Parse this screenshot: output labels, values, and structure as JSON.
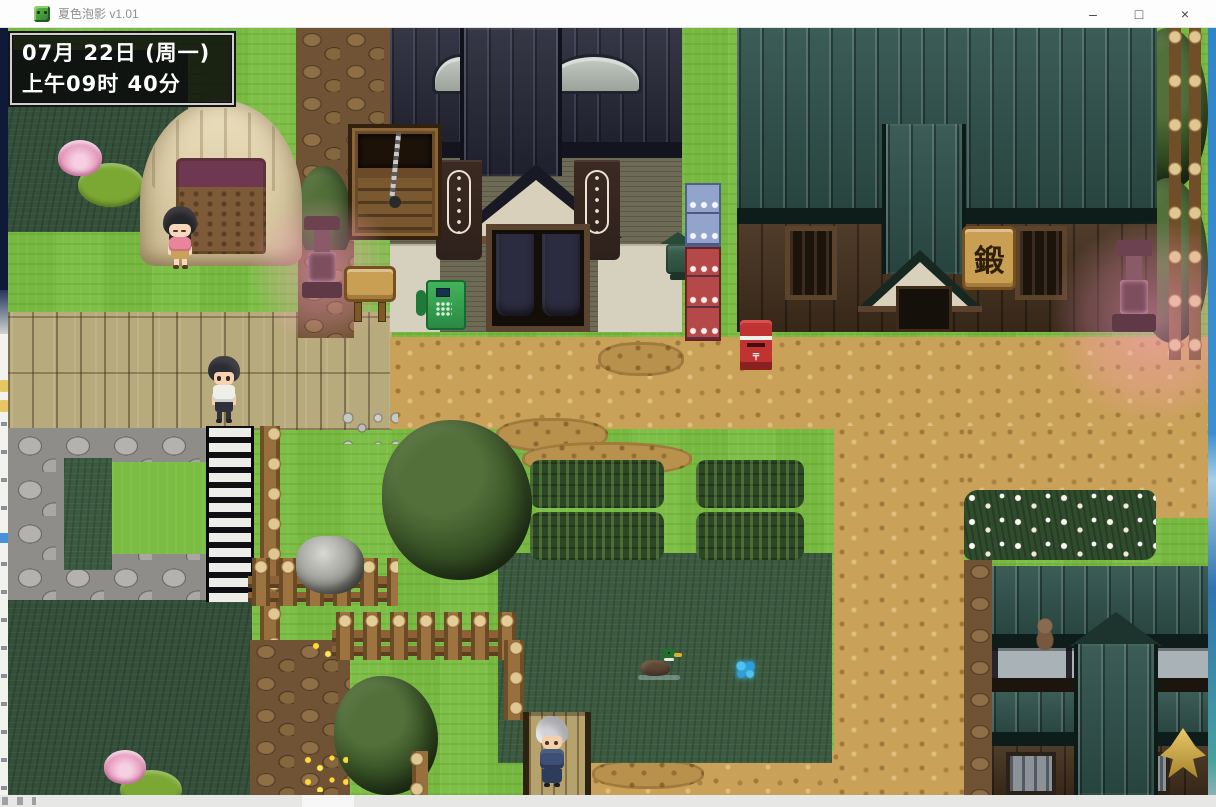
{
  "window": {
    "title": "夏色泡影 v1.01",
    "controls": {
      "minimize": "–",
      "maximize": "□",
      "close": "×"
    }
  },
  "hud": {
    "date": "07月 22日 (周一)",
    "time": "上午09时 40分"
  },
  "scene": {
    "blacksmith_sign": "鍛",
    "postbox_label": "〒"
  },
  "icons": {
    "app_icon": "green-creature-game-icon"
  },
  "palette": {
    "titlebar_bg": "#fdfdfd",
    "titlebar_text": "#8f8f8f",
    "control_glyph": "#3f3f3f",
    "desktop_blue": "#2e86c8",
    "grass": "#7abd42",
    "marsh": "#34503a",
    "field_green": "#3c5a40",
    "dirt": "#c9a158",
    "bridge_wood": "#b7aa7c",
    "cobble": "#8e8d89",
    "roof_navy": "#272838",
    "roof_teal": "#30524c",
    "wall_wood": "#46321f",
    "plaster": "#d6d0bf",
    "tatami": "#6d6a55",
    "crate_blue": "#93a4cc",
    "crate_red": "#b54848",
    "postbox_red": "#c13232",
    "sign_wood": "#c99f54",
    "glow_pink": "#ff9cc8",
    "hud_bg": "#0a0a0a",
    "hud_text": "#ffffff"
  }
}
